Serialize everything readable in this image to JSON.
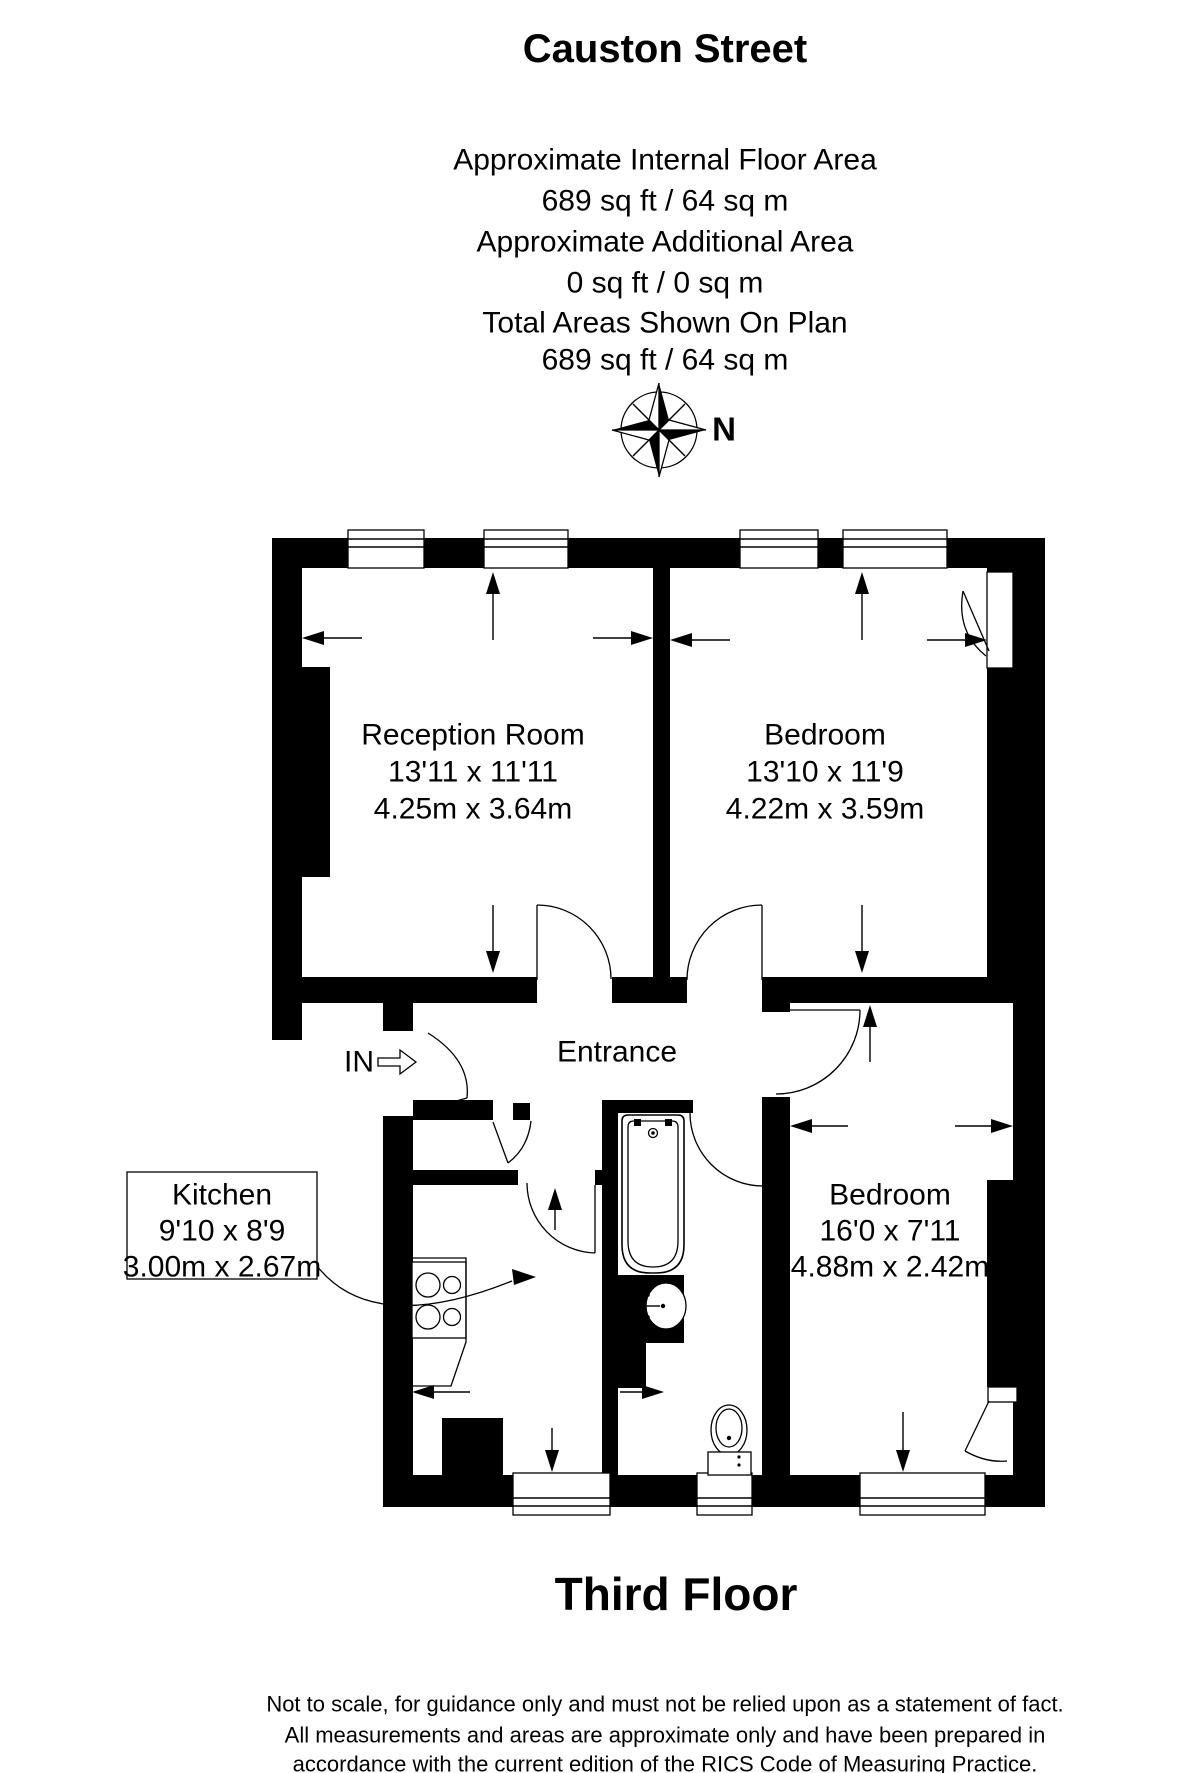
{
  "header": {
    "title": "Causton Street",
    "area": {
      "internal_label": "Approximate Internal Floor Area",
      "internal_value": "689 sq ft / 64 sq m",
      "additional_label": "Approximate Additional Area",
      "additional_value": "0 sq ft / 0 sq m",
      "total_label": "Total Areas Shown On Plan",
      "total_value": "689 sq ft / 64 sq m"
    }
  },
  "compass": {
    "north": "N"
  },
  "rooms": {
    "reception": {
      "name": "Reception Room",
      "imperial": "13'11 x 11'11",
      "metric": "4.25m x 3.64m"
    },
    "bedroom1": {
      "name": "Bedroom",
      "imperial": "13'10 x 11'9",
      "metric": "4.22m x 3.59m"
    },
    "bedroom2": {
      "name": "Bedroom",
      "imperial": "16'0 x 7'11",
      "metric": "4.88m x 2.42m"
    },
    "kitchen": {
      "name": "Kitchen",
      "imperial": "9'10 x 8'9",
      "metric": "3.00m x 2.67m"
    },
    "entrance": {
      "name": "Entrance"
    }
  },
  "entry": {
    "label": "IN"
  },
  "floor": {
    "label": "Third Floor"
  },
  "disclaimer": [
    "Not to scale, for guidance only and must not be relied upon as a statement of fact.",
    "All measurements and areas are approximate only and have been prepared in",
    "accordance with the current edition of the RICS Code of Measuring Practice."
  ],
  "colors": {
    "ink": "#000000",
    "paper": "#ffffff"
  }
}
